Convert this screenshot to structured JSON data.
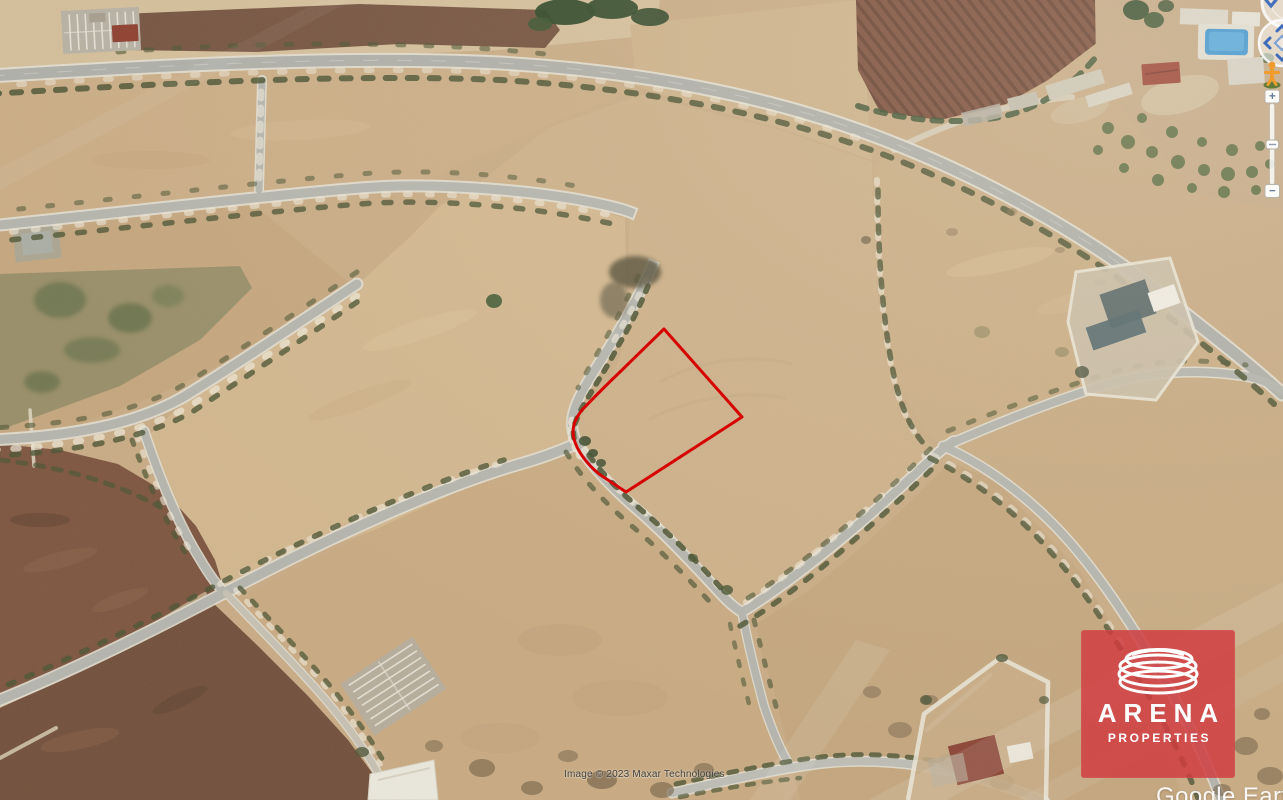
{
  "map": {
    "attribution": "Image © 2023 Maxar Technologies",
    "brand": "Google Earth",
    "plot": {
      "path": "M664,329 L742,417 L626,492 L599,474 Q579,457 574,439 Q570,425 582,410 Q601,390 622,370 Z",
      "color": "#d60000"
    }
  },
  "watermark": {
    "title": "ARENA",
    "subtitle": "PROPERTIES",
    "bg_color": "#d03c40",
    "icon": "arena-rings-logo"
  },
  "controls": {
    "zoom_in_label": "+",
    "zoom_out_label": "−",
    "icons": {
      "pegman": "street-view-pegman",
      "look_joystick": "look-around-joystick",
      "move_joystick": "pan-joystick",
      "zoom_slider": "zoom-slider"
    }
  }
}
